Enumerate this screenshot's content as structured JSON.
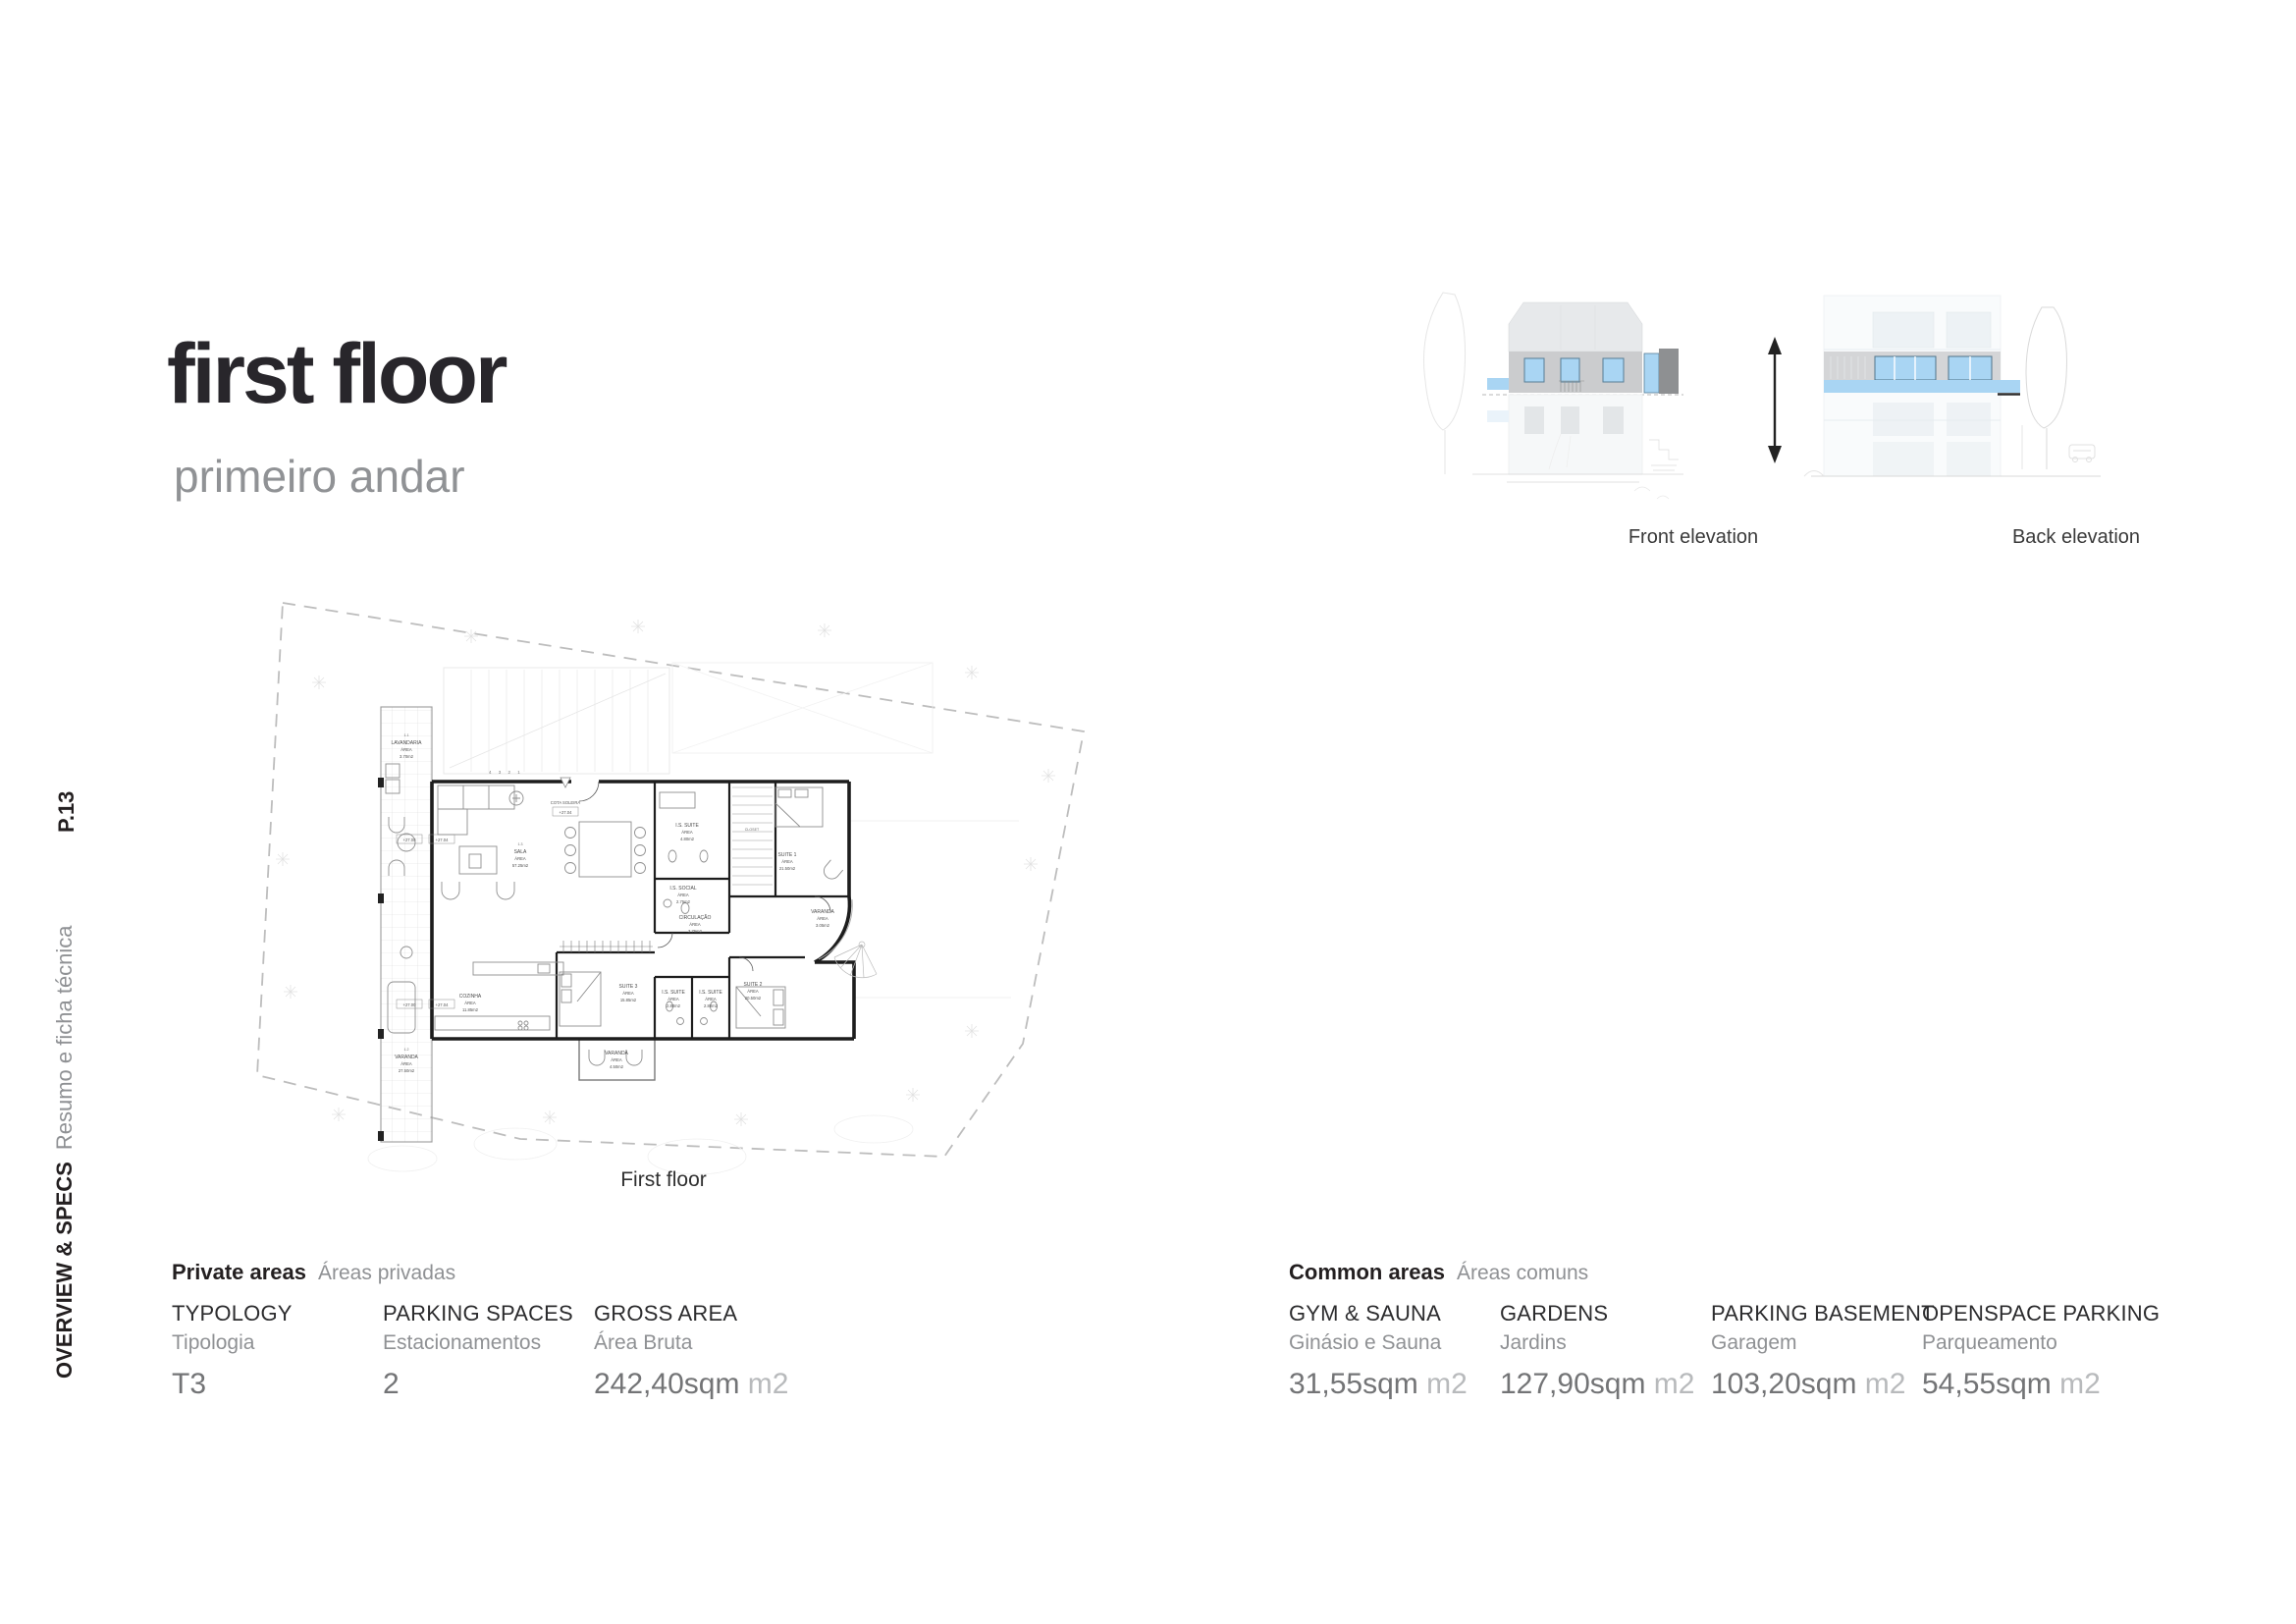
{
  "page": {
    "title": "first floor",
    "subtitle": "primeiro andar",
    "page_number": "P.13",
    "section_label": "OVERVIEW & SPECS",
    "section_sublabel": "Resumo e ficha técnica"
  },
  "elevations": {
    "front_caption": "Front elevation",
    "back_caption": "Back elevation"
  },
  "plan": {
    "caption": "First floor",
    "area_word": "ÁREA",
    "steps": "4 3 2 1",
    "entry": {
      "label": "COTA SOLEIRA",
      "level": "+27.04"
    },
    "levels": [
      "+27.00",
      "+27.04"
    ],
    "rooms": [
      {
        "code": "1.1",
        "name": "LAVANDARIA",
        "area": "3.70m2"
      },
      {
        "code": "1.2",
        "name": "VARANDA",
        "area": "27.50m2"
      },
      {
        "code": "1.3",
        "name": "SALA",
        "area": "57.25m2"
      },
      {
        "code": "",
        "name": "I.S. SUITE",
        "area": "4.80m2"
      },
      {
        "code": "",
        "name": "CLOSET",
        "area": ""
      },
      {
        "code": "",
        "name": "SUITE 1",
        "area": "21.50m2"
      },
      {
        "code": "",
        "name": "I.S. SOCIAL",
        "area": "2.75m2"
      },
      {
        "code": "",
        "name": "CIRCULAÇÃO",
        "area": "3.75m2"
      },
      {
        "code": "",
        "name": "VARANDA",
        "area": "3.05m2"
      },
      {
        "code": "",
        "name": "COZINHA",
        "area": "11.85m2"
      },
      {
        "code": "",
        "name": "SUITE 3",
        "area": "15.85m2"
      },
      {
        "code": "",
        "name": "I.S. SUITE",
        "area": "2.80m2"
      },
      {
        "code": "",
        "name": "I.S. SUITE",
        "area": "2.80m2"
      },
      {
        "code": "",
        "name": "SUITE 2",
        "area": "20.50m2"
      },
      {
        "code": "",
        "name": "VARANDA",
        "area": "4.50m2"
      }
    ]
  },
  "specs": {
    "private": {
      "title": "Private areas",
      "subtitle": "Áreas privadas",
      "items": [
        {
          "label": "TYPOLOGY",
          "sublabel": "Tipologia",
          "value": "T3",
          "unit": ""
        },
        {
          "label": "PARKING SPACES",
          "sublabel": "Estacionamentos",
          "value": "2",
          "unit": ""
        },
        {
          "label": "GROSS AREA",
          "sublabel": "Área Bruta",
          "value": "242,40sqm",
          "unit": " m2"
        }
      ]
    },
    "common": {
      "title": "Common areas",
      "subtitle": "Áreas comuns",
      "items": [
        {
          "label": "GYM & SAUNA",
          "sublabel": "Ginásio e Sauna",
          "value": "31,55sqm",
          "unit": " m2"
        },
        {
          "label": "GARDENS",
          "sublabel": "Jardins",
          "value": "127,90sqm",
          "unit": " m2"
        },
        {
          "label": "PARKING BASEMENT",
          "sublabel": "Garagem",
          "value": "103,20sqm",
          "unit": " m2"
        },
        {
          "label": "OPENSPACE PARKING",
          "sublabel": "Parqueamento",
          "value": "54,55sqm",
          "unit": " m2"
        }
      ]
    }
  },
  "colors": {
    "accent_blue": "#a9d5f3",
    "facade_gray": "#cbccce",
    "dark_gray": "#8e9092",
    "text_dark": "#231f20",
    "text_gray": "#8f9194",
    "value_gray": "#737476",
    "unit_gray": "#b8babc"
  }
}
